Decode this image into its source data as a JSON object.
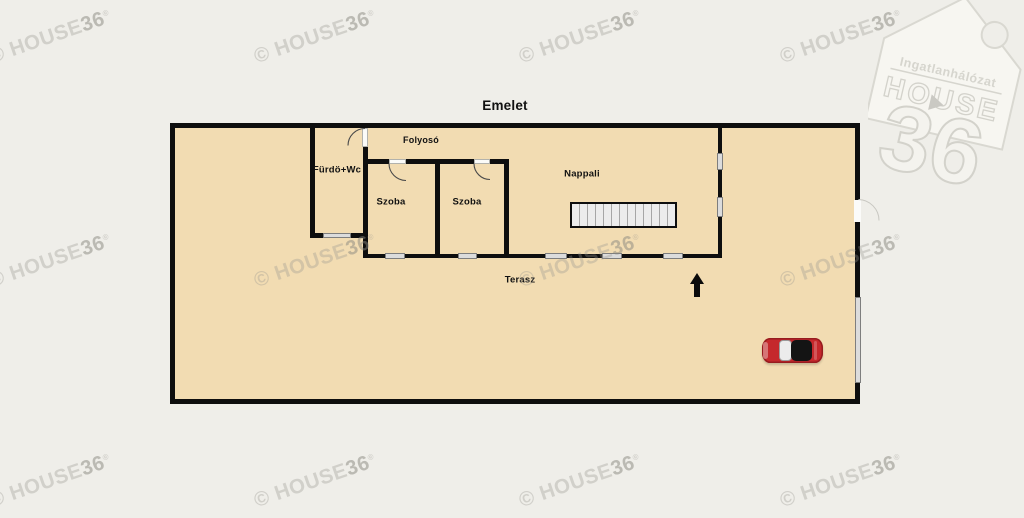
{
  "title": "Emelet",
  "floorplan": {
    "rooms": [
      {
        "id": "folyoso",
        "label": "Folyosó"
      },
      {
        "id": "furdo_wc",
        "label": "Fürdö+Wc"
      },
      {
        "id": "szoba_1",
        "label": "Szoba"
      },
      {
        "id": "szoba_2",
        "label": "Szoba"
      },
      {
        "id": "nappali",
        "label": "Nappali"
      },
      {
        "id": "terasz",
        "label": "Terasz"
      }
    ],
    "features": [
      "staircase",
      "entrance-arrow",
      "car"
    ]
  },
  "watermark": {
    "prefix": "© HOUSE",
    "bold": "36",
    "registered": "®"
  },
  "logo": {
    "network": "Ingatlanhálózat",
    "brand": "HOUSE",
    "number": "36"
  },
  "colors": {
    "background": "#efeee9",
    "floor": "#f2dcb2",
    "wall": "#0e0e0e",
    "window": "#dcdcdc",
    "stairs": "#ececec",
    "car_red": "#c5282c"
  }
}
